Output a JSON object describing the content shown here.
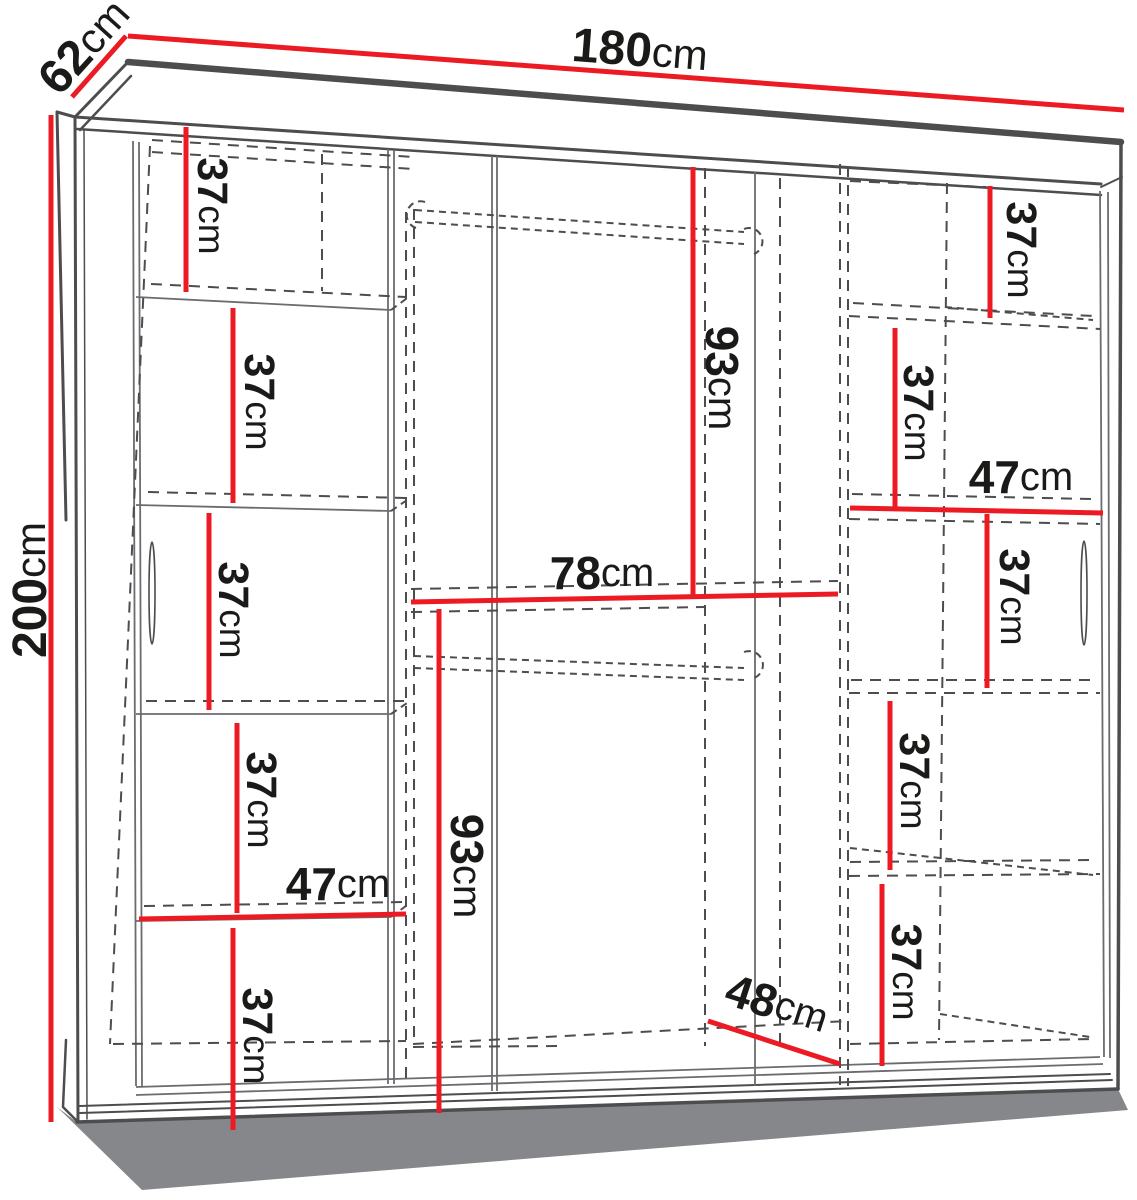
{
  "diagram": {
    "type": "furniture-dimension-diagram",
    "subject": "sliding-door wardrobe, front view with interior shelf layout",
    "unit": "cm",
    "accent_color": "#ec1b23",
    "line_color": "#4d4d4f",
    "text_color": "#1a1a18",
    "dimensions": {
      "total_width": {
        "value": "180",
        "unit": "cm"
      },
      "total_depth": {
        "value": "62",
        "unit": "cm"
      },
      "total_height": {
        "value": "200",
        "unit": "cm"
      },
      "left_column_width": {
        "value": "47",
        "unit": "cm"
      },
      "right_column_width": {
        "value": "47",
        "unit": "cm"
      },
      "middle_upper_height": {
        "value": "93",
        "unit": "cm"
      },
      "middle_shelf_width": {
        "value": "78",
        "unit": "cm"
      },
      "middle_lower_height": {
        "value": "93",
        "unit": "cm"
      },
      "interior_depth": {
        "value": "48",
        "unit": "cm"
      },
      "left_shelf_gaps": [
        {
          "value": "37",
          "unit": "cm"
        },
        {
          "value": "37",
          "unit": "cm"
        },
        {
          "value": "37",
          "unit": "cm"
        },
        {
          "value": "37",
          "unit": "cm"
        },
        {
          "value": "37",
          "unit": "cm"
        }
      ],
      "right_shelf_gaps": [
        {
          "value": "37",
          "unit": "cm"
        },
        {
          "value": "37",
          "unit": "cm"
        },
        {
          "value": "37",
          "unit": "cm"
        },
        {
          "value": "37",
          "unit": "cm"
        },
        {
          "value": "37",
          "unit": "cm"
        }
      ]
    }
  }
}
